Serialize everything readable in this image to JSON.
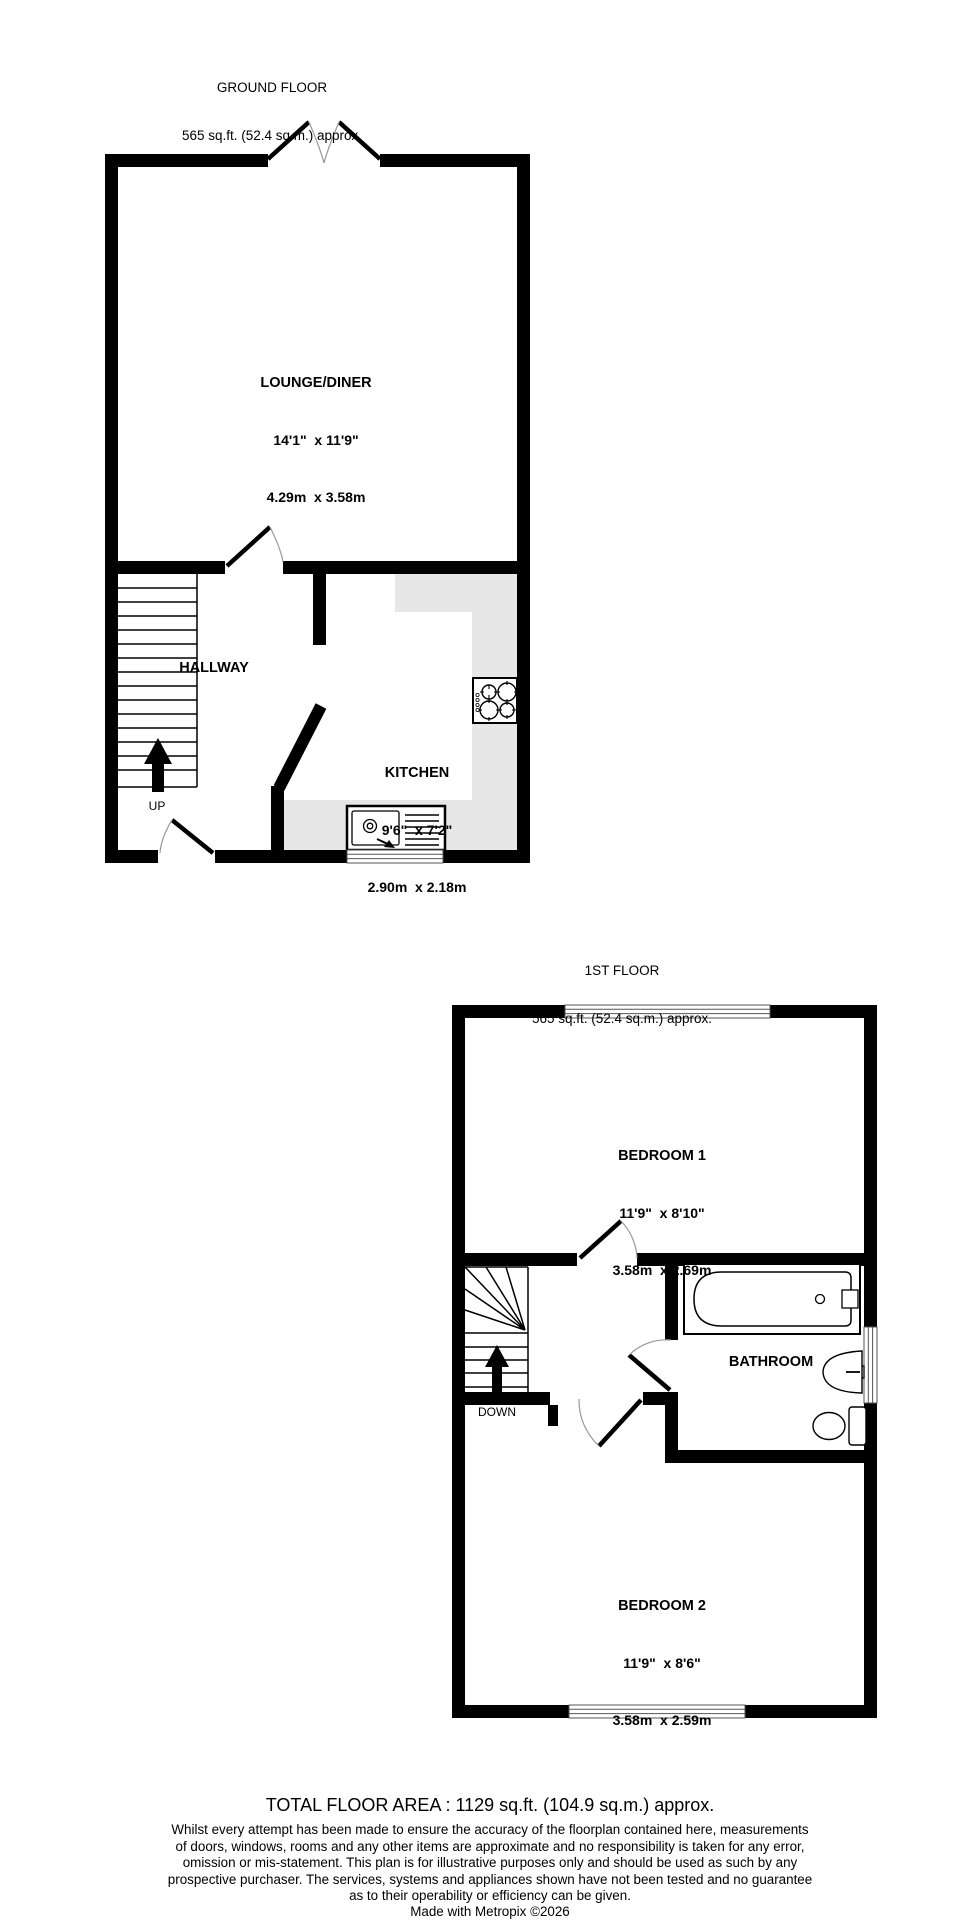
{
  "ground_floor": {
    "title": "GROUND FLOOR",
    "area": "565 sq.ft. (52.4 sq.m.) approx.",
    "rooms": {
      "lounge_diner": {
        "name": "LOUNGE/DINER",
        "size_imperial": "14'1\"  x 11'9\"",
        "size_metric": "4.29m  x 3.58m"
      },
      "hallway": {
        "name": "HALLWAY"
      },
      "kitchen": {
        "name": "KITCHEN",
        "size_imperial": "9'6\"  x 7'2\"",
        "size_metric": "2.90m  x 2.18m"
      }
    },
    "stair_direction": "UP"
  },
  "first_floor": {
    "title": "1ST FLOOR",
    "area": "565 sq.ft. (52.4 sq.m.) approx.",
    "rooms": {
      "bedroom_1": {
        "name": "BEDROOM 1",
        "size_imperial": "11'9\"  x 8'10\"",
        "size_metric": "3.58m  x 2.69m"
      },
      "bathroom": {
        "name": "BATHROOM"
      },
      "bedroom_2": {
        "name": "BEDROOM 2",
        "size_imperial": "11'9\"  x 8'6\"",
        "size_metric": "3.58m  x 2.59m"
      }
    },
    "stair_direction": "DOWN"
  },
  "footer": {
    "total_area": "TOTAL FLOOR AREA : 1129 sq.ft. (104.9 sq.m.) approx.",
    "disclaimer": "Whilst every attempt has been made to ensure the accuracy of the floorplan contained here, measurements\nof doors, windows, rooms and any other items are approximate and no responsibility is taken for any error,\nomission or mis-statement. This plan is for illustrative purposes only and should be used as such by any\nprospective purchaser. The services, systems and appliances shown have not been tested and no guarantee\nas to their operability or efficiency can be given.",
    "credit": "Made with Metropix ©2026"
  },
  "colors": {
    "wall": "#000000",
    "counter": "#e7e7e7",
    "door_arc": "#999999"
  }
}
